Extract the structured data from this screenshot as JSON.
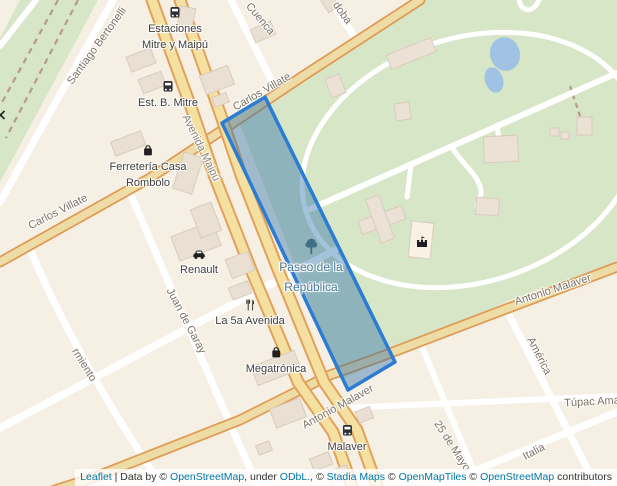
{
  "streets": {
    "santiago_bertonelli": "Santiago Bertonelli",
    "cuenca": "Cuenca",
    "cordoba_partial": "doba",
    "carlos_villate": "Carlos Villate",
    "avenida_maipu": "Avenida Maipú",
    "juan_de_garay": "Juan de Garay",
    "sarmiento_partial": "rmiento",
    "antonio_malaver": "Antonio Malaver",
    "america": "América",
    "tupac_amaru_partial": "Túpac Ama",
    "veinticinco_de_mayo": "25 de Mayo",
    "italia": "Italia"
  },
  "pois": {
    "estaciones_mitre_maipu": {
      "icon": "bus-icon",
      "line1": "Estaciones",
      "line2": "Mitre y Maipú"
    },
    "est_b_mitre": {
      "icon": "bus-icon",
      "label": "Est. B. Mitre"
    },
    "ferreteria": {
      "icon": "shopping-bag-icon",
      "line1": "Ferretería Casa",
      "line2": "Rombolo"
    },
    "renault": {
      "icon": "car-icon",
      "label": "Renault"
    },
    "la_5a_avenida": {
      "icon": "restaurant-icon",
      "label": "La 5a Avenida"
    },
    "megatronica": {
      "icon": "shopping-bag-icon",
      "label": "Megatrónica"
    },
    "malaver_stop": {
      "icon": "bus-icon",
      "label": "Malaver"
    },
    "paseo_de_la_republica": {
      "icon": "tree-icon",
      "line1": "Paseo de la",
      "line2": "República"
    },
    "park_attraction": {
      "icon": "castle-icon"
    }
  },
  "colors": {
    "highlight_stroke": "#2b7cd3",
    "highlight_fill": "rgba(40,110,170,0.42)",
    "water": "#a1c3e3",
    "park_green": "#d7e6c6",
    "road_primary_fill": "#f4e1a1",
    "road_primary_casing": "#e2a05a",
    "link": "#0077a8"
  },
  "attribution": {
    "leaflet": "Leaflet",
    "data_by": " | Data by © ",
    "osm_1": "OpenStreetMap",
    "under": ", under ",
    "odbl": "ODbL.",
    "comma_c": ", © ",
    "stadia": "Stadia Maps",
    "c2": " © ",
    "openmaptiles": "OpenMapTiles",
    "c3": " © ",
    "osm_2": "OpenStreetMap",
    "contributors": " contributors"
  }
}
